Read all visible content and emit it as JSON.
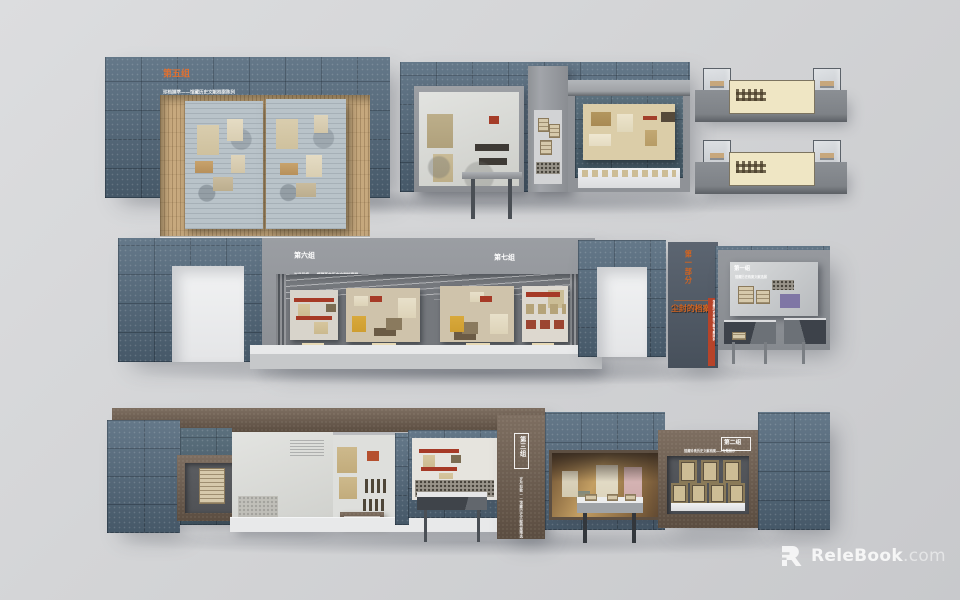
{
  "labels": {
    "group5": {
      "title": "第五组",
      "subtitle": "珍档撷萃——馆藏历史文献档案陈列"
    },
    "group6": {
      "title": "第六组",
      "subtitle": "岁月留痕——馆藏革命历史文献档案展"
    },
    "group7": {
      "title": "第七组",
      "subtitle": "烽火印记——馆藏抗战历史文献档案展"
    },
    "part1": {
      "title": "第一部分",
      "caption": "尘封的档案",
      "strip": "馆藏历史档案文献专题陈列"
    },
    "group1": {
      "title": "第一组",
      "caption": "馆藏历史档案文献选展"
    },
    "group3": {
      "title": "第三组",
      "subtitle": "岁月如歌——馆藏历史文献档案精选"
    },
    "group2": {
      "title": "第二组",
      "subtitle": "馆藏珍贵历史文献档案——专题展示"
    }
  },
  "watermark": {
    "brand": "ReleBook",
    "suffix": ".com"
  },
  "palette": {
    "background": "#d2d3d5",
    "tile_blue": "#53697c",
    "wall_gray": "#8f9297",
    "slate_panel": "#4c5662",
    "wood_brown": "#6f5e4f",
    "accent_orange": "#d4641f",
    "accent_red": "#b03a25",
    "base_white": "#e9eaeb"
  }
}
